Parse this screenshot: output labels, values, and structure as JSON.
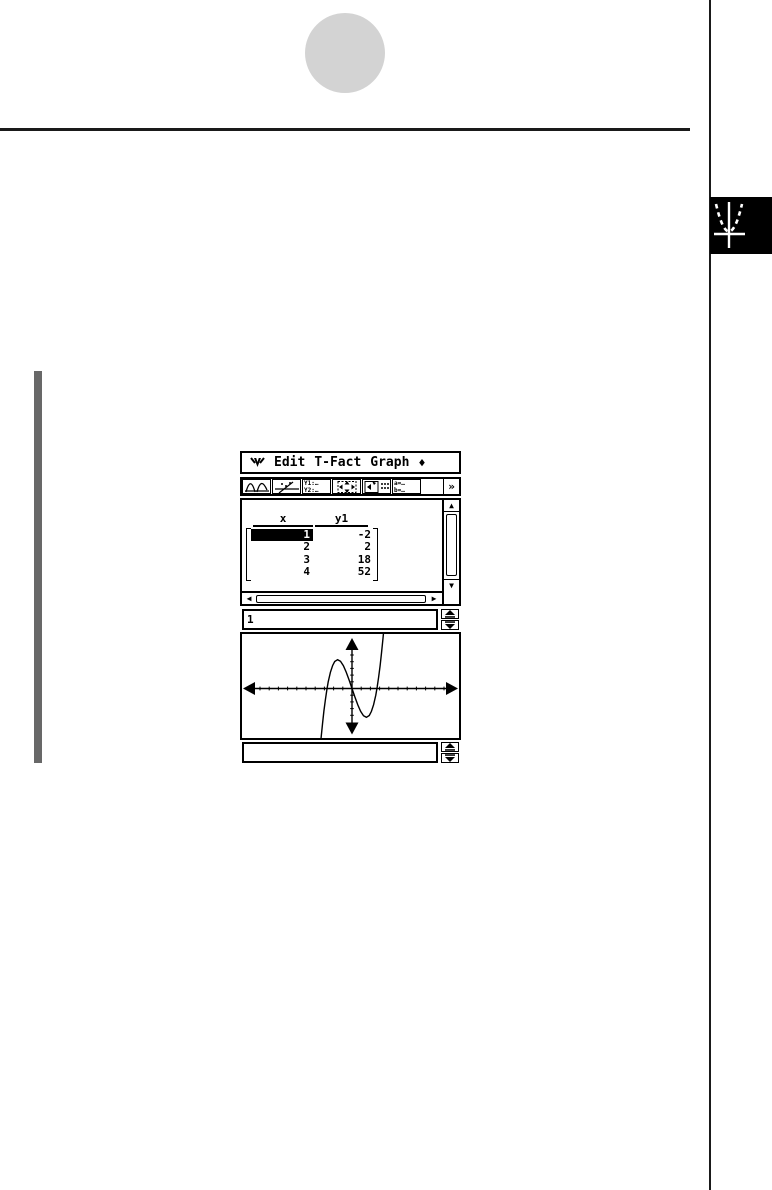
{
  "app": {
    "menubar": {
      "menu_icon": "classpad-menu-arrow",
      "items": [
        "Edit",
        "T-Fact",
        "Graph"
      ],
      "trailing_symbol": "♦"
    },
    "toolbar": {
      "icons": [
        {
          "name": "graph-curves"
        },
        {
          "name": "graph-trace"
        },
        {
          "name": "graph-editor",
          "lines": [
            "Y1:…",
            "Y2:…"
          ]
        },
        {
          "name": "resize-window"
        },
        {
          "name": "table-input"
        },
        {
          "name": "variables",
          "lines": [
            "a=…",
            "b=…"
          ]
        },
        {
          "name": "blank"
        },
        {
          "name": "toolbar-overflow",
          "label": "»"
        }
      ]
    },
    "table": {
      "columns": [
        "x",
        "y1"
      ],
      "rows": [
        [
          "1",
          "-2"
        ],
        [
          "2",
          "2"
        ],
        [
          "3",
          "18"
        ],
        [
          "4",
          "52"
        ]
      ],
      "selected_cell": {
        "row": 0,
        "column": "x"
      }
    },
    "cell_input": {
      "value": "1"
    },
    "graph": {
      "type": "function-plot",
      "curve_shape": "cubic rising left-to-right, local maximum left of y-axis, local minimum right of y-axis",
      "table_points": {
        "x": [
          1,
          2,
          3,
          4
        ],
        "y1": [
          -2,
          2,
          18,
          52
        ]
      },
      "axes": {
        "x_arrows": "both",
        "y_arrows": "both",
        "ticks": "on"
      }
    },
    "graph_input": {
      "value": ""
    }
  },
  "decorations": {
    "chapter_tab_icon": "parabola-axes-icon",
    "colors": {
      "circle": "#d3d3d3",
      "sidebar_bar": "#686868",
      "rule": "#1a1a1a",
      "tab_bg": "#000000"
    }
  }
}
